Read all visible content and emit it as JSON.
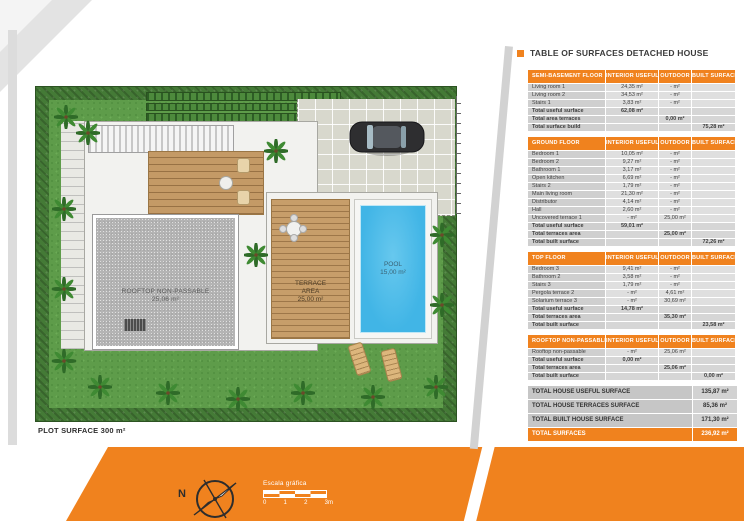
{
  "title": "TABLE OF SURFACES DETACHED HOUSE",
  "plan": {
    "plot_label": "PLOT SURFACE 300 m²",
    "rooftop_label": "ROOFTOP NON-PASSABLE",
    "rooftop_area": "25,06 m²",
    "terrace_label_1": "TERRACE",
    "terrace_label_2": "AREA",
    "terrace_area": "25,00 m²",
    "pool_label": "POOL",
    "pool_area": "15,00 m²"
  },
  "legend": {
    "north_label": "N",
    "scale_title": "Escala gráfica",
    "scale_ticks": [
      "0",
      "1",
      "2",
      "3m"
    ]
  },
  "table": {
    "columns": [
      "INTERIOR USEFUL",
      "OUTDOOR",
      "BUILT SURFACE"
    ],
    "sections": [
      {
        "name": "SEMI-BASEMENT FLOOR",
        "rows": [
          {
            "label": "Living room 1",
            "interior": "24,35 m²",
            "outdoor": "- m²",
            "built": ""
          },
          {
            "label": "Living room 2",
            "interior": "34,53 m²",
            "outdoor": "- m²",
            "built": ""
          },
          {
            "label": "Stairs 1",
            "interior": "3,83 m²",
            "outdoor": "- m²",
            "built": ""
          }
        ],
        "totals": [
          {
            "label": "Total useful surface",
            "interior": "62,08 m²",
            "outdoor": "",
            "built": ""
          },
          {
            "label": "Total area terraces",
            "interior": "",
            "outdoor": "0,00 m²",
            "built": ""
          },
          {
            "label": "Total surface build",
            "interior": "",
            "outdoor": "",
            "built": "75,28 m²"
          }
        ]
      },
      {
        "name": "GROUND FLOOR",
        "rows": [
          {
            "label": "Bedroom 1",
            "interior": "10,05 m²",
            "outdoor": "- m²",
            "built": ""
          },
          {
            "label": "Bedroom 2",
            "interior": "9,27 m²",
            "outdoor": "- m²",
            "built": ""
          },
          {
            "label": "Bathroom 1",
            "interior": "3,17 m²",
            "outdoor": "- m²",
            "built": ""
          },
          {
            "label": "Open kitchen",
            "interior": "6,69 m²",
            "outdoor": "- m²",
            "built": ""
          },
          {
            "label": "Stairs 2",
            "interior": "1,79 m²",
            "outdoor": "- m²",
            "built": ""
          },
          {
            "label": "Main living room",
            "interior": "21,30 m²",
            "outdoor": "- m²",
            "built": ""
          },
          {
            "label": "Distributor",
            "interior": "4,14 m²",
            "outdoor": "- m²",
            "built": ""
          },
          {
            "label": "Hall",
            "interior": "2,60 m²",
            "outdoor": "- m²",
            "built": ""
          },
          {
            "label": "Uncovered terrace 1",
            "interior": "- m²",
            "outdoor": "25,00 m²",
            "built": ""
          }
        ],
        "totals": [
          {
            "label": "Total useful surface",
            "interior": "59,01 m²",
            "outdoor": "",
            "built": ""
          },
          {
            "label": "Total terraces area",
            "interior": "",
            "outdoor": "25,00 m²",
            "built": ""
          },
          {
            "label": "Total built surface",
            "interior": "",
            "outdoor": "",
            "built": "72,26 m²"
          }
        ]
      },
      {
        "name": "TOP FLOOR",
        "rows": [
          {
            "label": "Bedroom 3",
            "interior": "9,41 m²",
            "outdoor": "- m²",
            "built": ""
          },
          {
            "label": "Bathroom 2",
            "interior": "3,58 m²",
            "outdoor": "- m²",
            "built": ""
          },
          {
            "label": "Stairs 3",
            "interior": "1,79 m²",
            "outdoor": "- m²",
            "built": ""
          },
          {
            "label": "Pergola terrace 2",
            "interior": "- m²",
            "outdoor": "4,61 m²",
            "built": ""
          },
          {
            "label": "Solarium terrace 3",
            "interior": "- m²",
            "outdoor": "30,69 m²",
            "built": ""
          }
        ],
        "totals": [
          {
            "label": "Total useful surface",
            "interior": "14,78 m²",
            "outdoor": "",
            "built": ""
          },
          {
            "label": "Total terraces area",
            "interior": "",
            "outdoor": "35,30 m²",
            "built": ""
          },
          {
            "label": "Total built surface",
            "interior": "",
            "outdoor": "",
            "built": "23,58 m²"
          }
        ]
      },
      {
        "name": "ROOFTOP NON-PASSABLE",
        "rows": [
          {
            "label": "Rooftop non-passable",
            "interior": "- m²",
            "outdoor": "25,06 m²",
            "built": ""
          }
        ],
        "totals": [
          {
            "label": "Total useful surface",
            "interior": "0,00 m²",
            "outdoor": "",
            "built": ""
          },
          {
            "label": "Total terraces area",
            "interior": "",
            "outdoor": "25,06 m²",
            "built": ""
          },
          {
            "label": "Total built surface",
            "interior": "",
            "outdoor": "",
            "built": "0,00 m²"
          }
        ]
      }
    ],
    "summary": [
      {
        "label": "TOTAL HOUSE USEFUL SURFACE",
        "value": "135,87 m²",
        "highlight": false
      },
      {
        "label": "TOTAL HOUSE TERRACES SURFACE",
        "value": "85,36 m²",
        "highlight": false
      },
      {
        "label": "TOTAL BUILT HOUSE SURFACE",
        "value": "171,30 m²",
        "highlight": false
      },
      {
        "label": "TOTAL SURFACES",
        "value": "236,92 m²",
        "highlight": true
      }
    ]
  },
  "colors": {
    "accent": "#F0821E",
    "pool": "#41B5E6",
    "wood": "#C49A66",
    "hedge": "#447A36",
    "grass": "#5E9C4A",
    "concrete": "#B4B4B4",
    "table_row": "#CFCFCF"
  }
}
